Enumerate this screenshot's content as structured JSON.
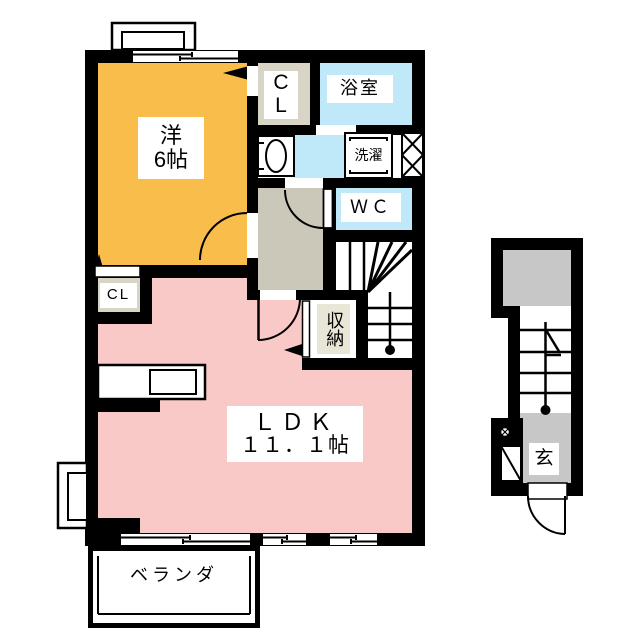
{
  "floorplan": {
    "title": "1LDK apartment floor plan",
    "rooms": {
      "western": {
        "name_line1": "洋",
        "name_line2": "6帖"
      },
      "closet_top": {
        "line1": "C",
        "line2": "L"
      },
      "bathroom": {
        "label": "浴室"
      },
      "laundry": {
        "label": "洗濯"
      },
      "toilet": {
        "label": "ＷＣ"
      },
      "storage": {
        "label": "収納"
      },
      "closet_ldk": {
        "label": "CL"
      },
      "ldk": {
        "name": "ＬＤＫ",
        "size": "１１．１帖"
      },
      "veranda": {
        "label": "ベランダ"
      },
      "entrance": {
        "label": "玄"
      }
    },
    "colors": {
      "western_room": "#F9BD4C",
      "ldk_pink": "#F9C9C7",
      "water_blue": "#BFE9F8",
      "hallway_gray": "#CBC8BA",
      "closet_beige": "#D8D5C6",
      "annex_gray": "#C7C7C7",
      "storage_label_bg": "#E9E6D8",
      "wall": "#000000"
    }
  }
}
